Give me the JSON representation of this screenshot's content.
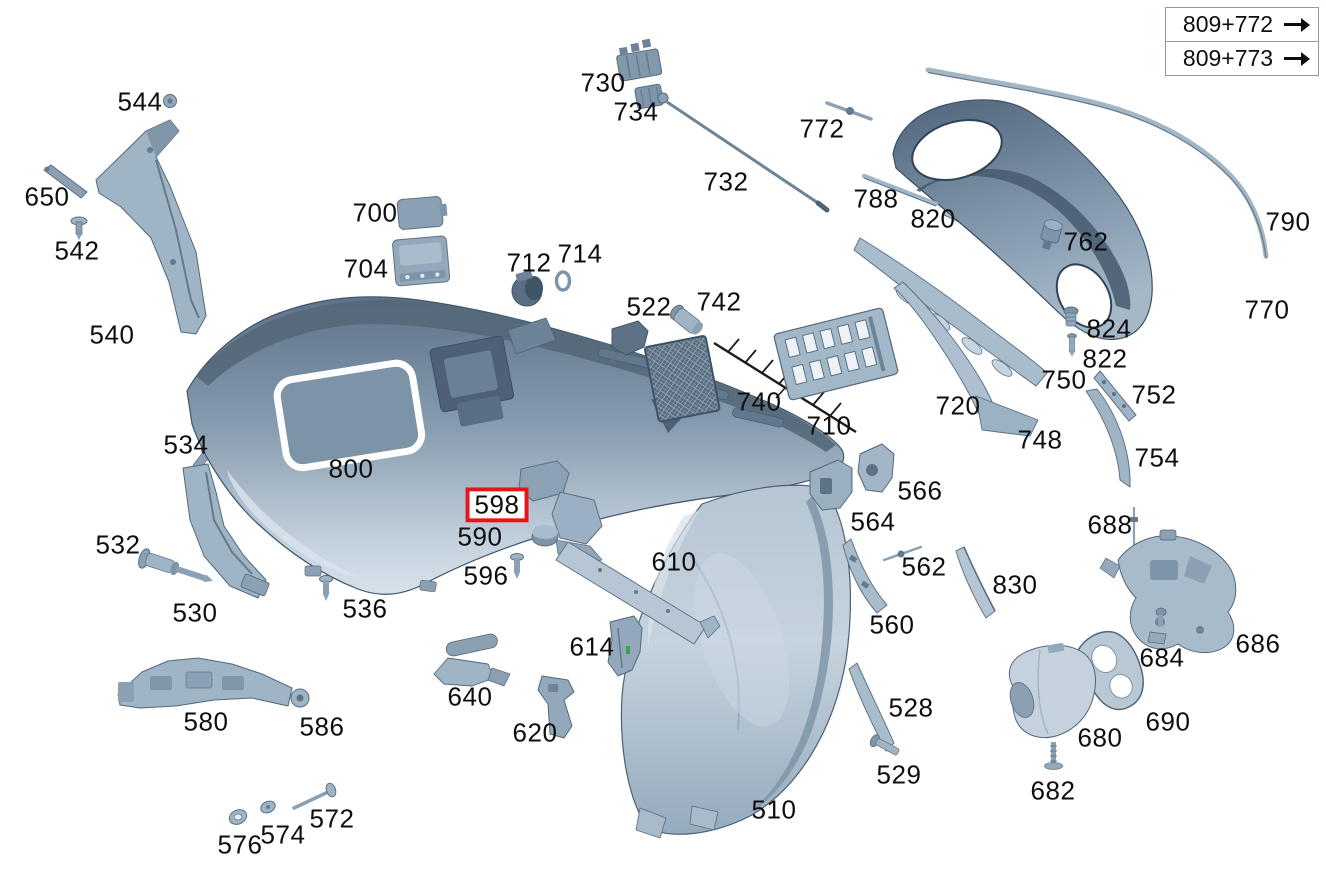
{
  "diagram": {
    "title": "Rear bumper exploded parts diagram",
    "background_color": "#ffffff",
    "label_color": "#0e0e0e",
    "highlight_color": "#e8141c",
    "highlighted_part": "598",
    "reference_links": [
      {
        "label": "809+772",
        "icon": "arrow-right-icon"
      },
      {
        "label": "809+773",
        "icon": "arrow-right-icon"
      }
    ],
    "part_labels": [
      {
        "text": "544",
        "x": 140,
        "y": 102,
        "highlighted": false
      },
      {
        "text": "650",
        "x": 47,
        "y": 197,
        "highlighted": false
      },
      {
        "text": "542",
        "x": 77,
        "y": 251,
        "highlighted": false
      },
      {
        "text": "540",
        "x": 112,
        "y": 335,
        "highlighted": false
      },
      {
        "text": "534",
        "x": 186,
        "y": 445,
        "highlighted": false
      },
      {
        "text": "532",
        "x": 118,
        "y": 545,
        "highlighted": false
      },
      {
        "text": "530",
        "x": 195,
        "y": 613,
        "highlighted": false
      },
      {
        "text": "580",
        "x": 206,
        "y": 722,
        "highlighted": false
      },
      {
        "text": "586",
        "x": 322,
        "y": 727,
        "highlighted": false
      },
      {
        "text": "576",
        "x": 240,
        "y": 845,
        "highlighted": false
      },
      {
        "text": "574",
        "x": 283,
        "y": 835,
        "highlighted": false
      },
      {
        "text": "572",
        "x": 332,
        "y": 819,
        "highlighted": false
      },
      {
        "text": "536",
        "x": 365,
        "y": 609,
        "highlighted": false
      },
      {
        "text": "800",
        "x": 351,
        "y": 469,
        "highlighted": false
      },
      {
        "text": "598",
        "x": 497,
        "y": 505,
        "highlighted": true
      },
      {
        "text": "590",
        "x": 480,
        "y": 537,
        "highlighted": false
      },
      {
        "text": "596",
        "x": 486,
        "y": 576,
        "highlighted": false
      },
      {
        "text": "640",
        "x": 470,
        "y": 697,
        "highlighted": false
      },
      {
        "text": "620",
        "x": 535,
        "y": 733,
        "highlighted": false
      },
      {
        "text": "614",
        "x": 592,
        "y": 647,
        "highlighted": false
      },
      {
        "text": "610",
        "x": 674,
        "y": 562,
        "highlighted": false
      },
      {
        "text": "510",
        "x": 774,
        "y": 810,
        "highlighted": false
      },
      {
        "text": "700",
        "x": 375,
        "y": 213,
        "highlighted": false
      },
      {
        "text": "704",
        "x": 366,
        "y": 269,
        "highlighted": false
      },
      {
        "text": "712",
        "x": 529,
        "y": 263,
        "highlighted": false
      },
      {
        "text": "714",
        "x": 580,
        "y": 254,
        "highlighted": false
      },
      {
        "text": "730",
        "x": 603,
        "y": 83,
        "highlighted": false
      },
      {
        "text": "734",
        "x": 636,
        "y": 112,
        "highlighted": false
      },
      {
        "text": "732",
        "x": 726,
        "y": 182,
        "highlighted": false
      },
      {
        "text": "522",
        "x": 649,
        "y": 307,
        "highlighted": false
      },
      {
        "text": "742",
        "x": 719,
        "y": 302,
        "highlighted": false
      },
      {
        "text": "740",
        "x": 759,
        "y": 402,
        "highlighted": false
      },
      {
        "text": "710",
        "x": 829,
        "y": 426,
        "highlighted": false
      },
      {
        "text": "720",
        "x": 958,
        "y": 406,
        "highlighted": false
      },
      {
        "text": "748",
        "x": 1040,
        "y": 440,
        "highlighted": false
      },
      {
        "text": "750",
        "x": 1064,
        "y": 380,
        "highlighted": false
      },
      {
        "text": "824",
        "x": 1109,
        "y": 329,
        "highlighted": false
      },
      {
        "text": "822",
        "x": 1105,
        "y": 359,
        "highlighted": false
      },
      {
        "text": "772",
        "x": 822,
        "y": 129,
        "highlighted": false
      },
      {
        "text": "788",
        "x": 876,
        "y": 199,
        "highlighted": false
      },
      {
        "text": "820",
        "x": 933,
        "y": 219,
        "highlighted": false
      },
      {
        "text": "762",
        "x": 1086,
        "y": 242,
        "highlighted": false
      },
      {
        "text": "790",
        "x": 1288,
        "y": 222,
        "highlighted": false
      },
      {
        "text": "770",
        "x": 1267,
        "y": 310,
        "highlighted": false
      },
      {
        "text": "752",
        "x": 1154,
        "y": 395,
        "highlighted": false
      },
      {
        "text": "754",
        "x": 1157,
        "y": 458,
        "highlighted": false
      },
      {
        "text": "566",
        "x": 920,
        "y": 491,
        "highlighted": false
      },
      {
        "text": "564",
        "x": 873,
        "y": 522,
        "highlighted": false
      },
      {
        "text": "562",
        "x": 924,
        "y": 567,
        "highlighted": false
      },
      {
        "text": "560",
        "x": 892,
        "y": 625,
        "highlighted": false
      },
      {
        "text": "830",
        "x": 1015,
        "y": 585,
        "highlighted": false
      },
      {
        "text": "528",
        "x": 911,
        "y": 708,
        "highlighted": false
      },
      {
        "text": "529",
        "x": 899,
        "y": 775,
        "highlighted": false
      },
      {
        "text": "688",
        "x": 1110,
        "y": 525,
        "highlighted": false
      },
      {
        "text": "686",
        "x": 1258,
        "y": 644,
        "highlighted": false
      },
      {
        "text": "684",
        "x": 1162,
        "y": 658,
        "highlighted": false
      },
      {
        "text": "690",
        "x": 1168,
        "y": 722,
        "highlighted": false
      },
      {
        "text": "680",
        "x": 1100,
        "y": 738,
        "highlighted": false
      },
      {
        "text": "682",
        "x": 1053,
        "y": 791,
        "highlighted": false
      }
    ]
  }
}
